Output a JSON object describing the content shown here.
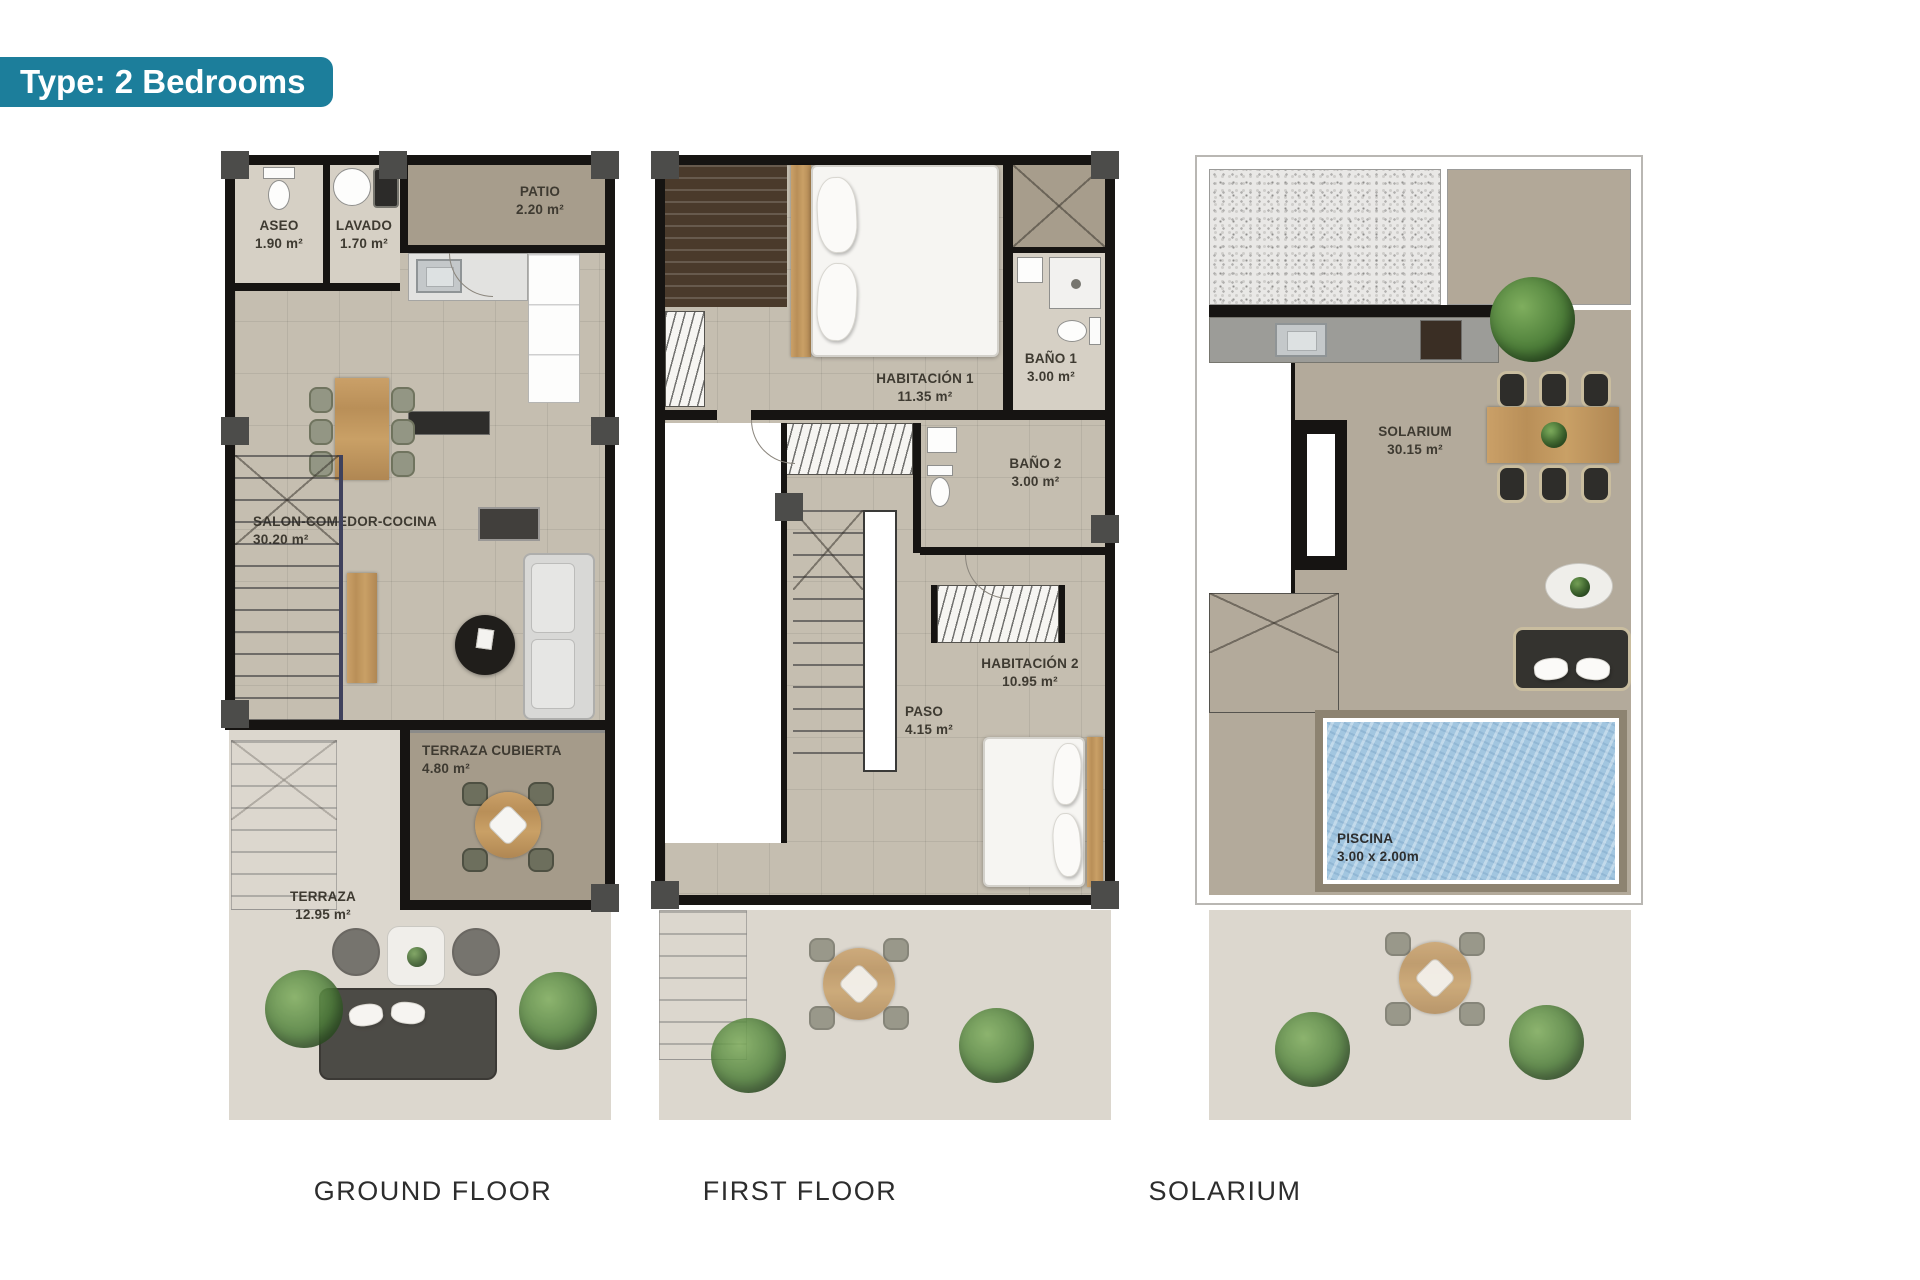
{
  "badge": {
    "label": "Type: 2 Bedrooms"
  },
  "colors": {
    "badge_bg": "#1c7e9b",
    "wall": "#161412",
    "floor": "#c5beb0",
    "terrace_floor": "#a79d8c",
    "pool_water": "#a2c6e0",
    "wood": "#c09a66",
    "caption_text": "#2d2d2d"
  },
  "plans": [
    {
      "caption": "GROUND FLOOR",
      "rooms": {
        "aseo": {
          "name": "ASEO",
          "area": "1.90 m²"
        },
        "lavado": {
          "name": "LAVADO",
          "area": "1.70 m²"
        },
        "patio": {
          "name": "PATIO",
          "area": "2.20 m²"
        },
        "salon": {
          "name": "SALON-COMEDOR-COCINA",
          "area": "30.20 m²"
        },
        "terraza_cubierta": {
          "name": "TERRAZA CUBIERTA",
          "area": "4.80 m²"
        },
        "terraza": {
          "name": "TERRAZA",
          "area": "12.95 m²"
        }
      }
    },
    {
      "caption": "FIRST FLOOR",
      "rooms": {
        "habitacion1": {
          "name": "HABITACIÓN 1",
          "area": "11.35 m²"
        },
        "bano1": {
          "name": "BAÑO 1",
          "area": "3.00 m²"
        },
        "bano2": {
          "name": "BAÑO 2",
          "area": "3.00 m²"
        },
        "habitacion2": {
          "name": "HABITACIÓN 2",
          "area": "10.95 m²"
        },
        "paso": {
          "name": "PASO",
          "area": "4.15 m²"
        }
      }
    },
    {
      "caption": "SOLARIUM",
      "rooms": {
        "solarium": {
          "name": "SOLARIUM",
          "area": "30.15 m²"
        },
        "piscina": {
          "name": "PISCINA",
          "area": "3.00 x 2.00m"
        }
      }
    }
  ]
}
